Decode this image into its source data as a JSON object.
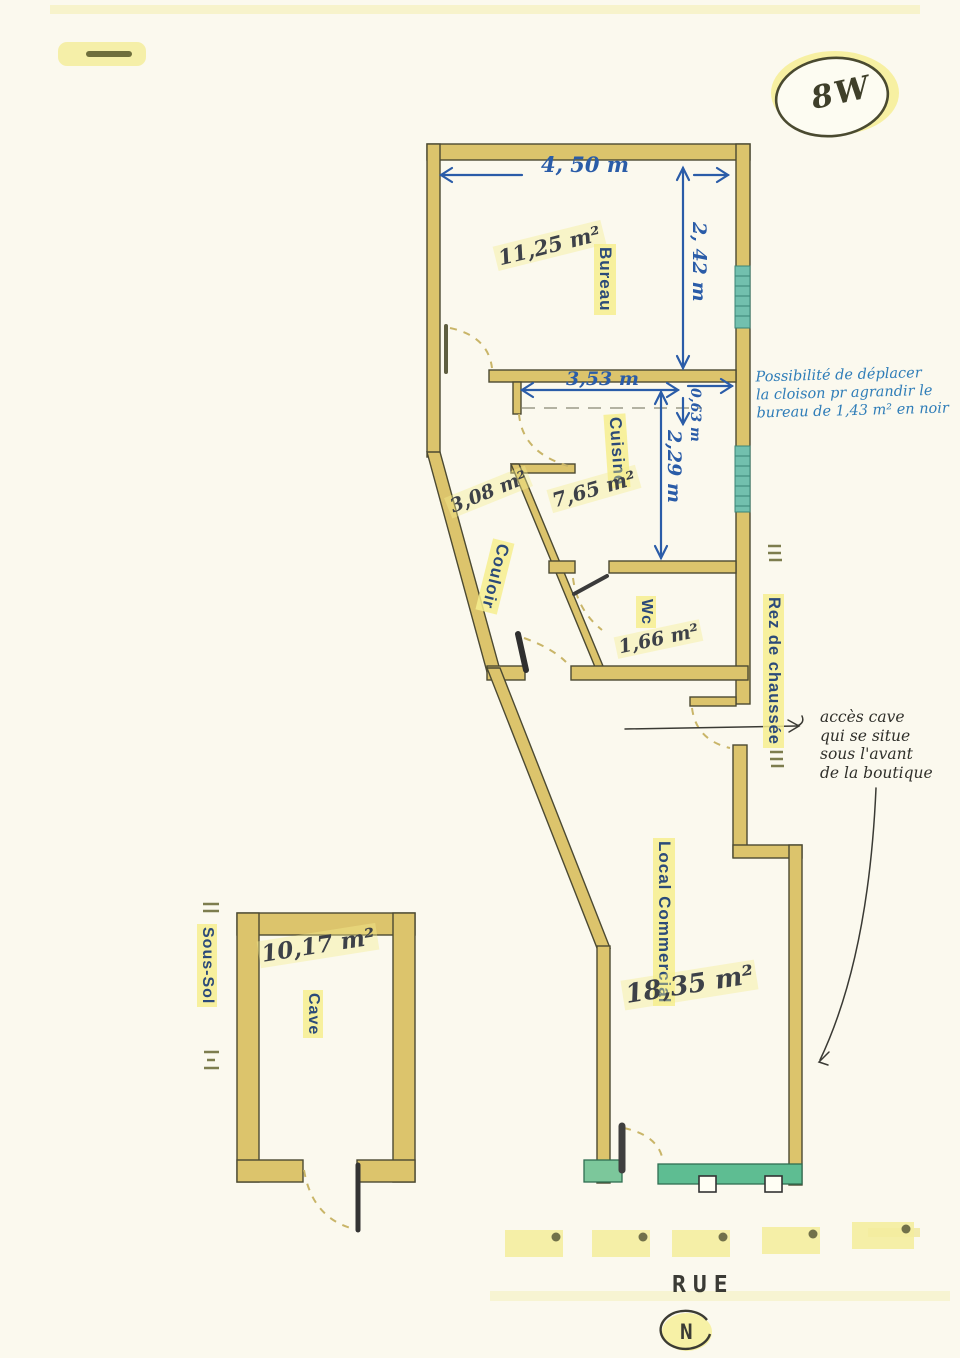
{
  "ref": {
    "label": "8W"
  },
  "levels": {
    "ground": "Rez de chaussée",
    "basement": "Sous-Sol"
  },
  "street": {
    "label": "RUE",
    "north": "N"
  },
  "rooms": {
    "bureau": {
      "name": "Bureau",
      "area": "11,25 m²"
    },
    "cuisine": {
      "name": "Cuisine",
      "area": "7,65 m²"
    },
    "couloir": {
      "name": "Couloir",
      "area": "3,08 m²"
    },
    "wc": {
      "name": "Wc",
      "area": "1,66 m²"
    },
    "local_commercial": {
      "name": "Local Commercial",
      "area": "18,35 m²"
    },
    "cave": {
      "name": "Cave",
      "area": "10,17 m²"
    }
  },
  "dimensions": {
    "bureau_width": "4, 50 m",
    "bureau_depth": "2, 42 m",
    "cuisine_width": "3,53 m",
    "wall_offset": "0,63 m",
    "cuisine_depth": "2,29 m"
  },
  "notes": {
    "partition_lines": [
      "Possibilité de déplacer",
      "la cloison pr agrandir le",
      "bureau de 1,43 m² en noir"
    ],
    "cave_access_lines": [
      "accès cave",
      "qui se situe",
      "sous l'avant",
      "de la boutique"
    ]
  },
  "colors": {
    "wall": "#dcc46c",
    "window": "#72c0ae",
    "storefront": "#5ebd92",
    "dimension_ink": "#2a5ca8",
    "note_ink": "#2f7db8",
    "label_ink": "#2b4a79",
    "highlight": "#f6ee8e"
  }
}
